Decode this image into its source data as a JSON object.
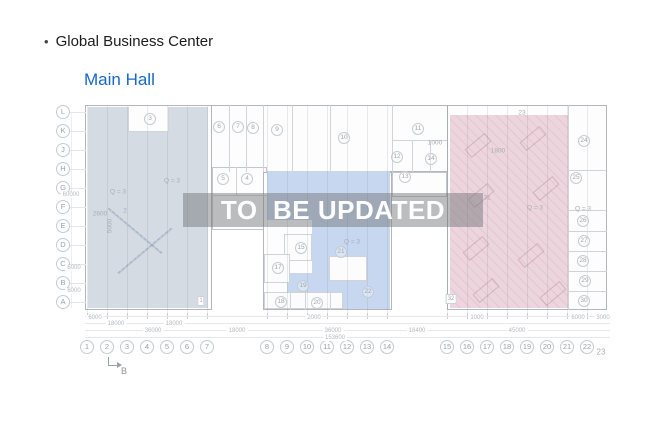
{
  "header": {
    "bullet": "•",
    "title": "Global Business Center",
    "subtitle": "Main Hall",
    "subtitle_color": "#1668c6"
  },
  "watermark": {
    "text": "TO  BE UPDATED"
  },
  "plan": {
    "colors": {
      "left_region": "#d4dbe3",
      "middle_region": "#c7d7f0",
      "right_region": "#edd5dd",
      "outer_wall": "#b3b7bc",
      "inner_wall": "#d0d4d9",
      "label_gray": "#a8adb4"
    },
    "row_labels": [
      "L",
      "K",
      "J",
      "H",
      "G",
      "F",
      "E",
      "D",
      "C",
      "B",
      "A"
    ],
    "col_labels": [
      {
        "label": "1",
        "x": 87
      },
      {
        "label": "2",
        "x": 107
      },
      {
        "label": "3",
        "x": 127
      },
      {
        "label": "4",
        "x": 147
      },
      {
        "label": "5",
        "x": 167
      },
      {
        "label": "6",
        "x": 187
      },
      {
        "label": "7",
        "x": 207
      },
      {
        "label": "8",
        "x": 267
      },
      {
        "label": "9",
        "x": 287
      },
      {
        "label": "10",
        "x": 307
      },
      {
        "label": "11",
        "x": 327
      },
      {
        "label": "12",
        "x": 347
      },
      {
        "label": "13",
        "x": 367
      },
      {
        "label": "14",
        "x": 387
      },
      {
        "label": "15",
        "x": 447
      },
      {
        "label": "16",
        "x": 467
      },
      {
        "label": "17",
        "x": 487
      },
      {
        "label": "18",
        "x": 507
      },
      {
        "label": "19",
        "x": 527
      },
      {
        "label": "20",
        "x": 547
      },
      {
        "label": "21",
        "x": 567
      },
      {
        "label": "22",
        "x": 587
      },
      {
        "label": "23",
        "x": 601,
        "y": 352,
        "plain": true
      }
    ],
    "rooms": [
      {
        "n": "3",
        "x": 150,
        "y": 119
      },
      {
        "n": "6",
        "x": 219,
        "y": 127
      },
      {
        "n": "7",
        "x": 238,
        "y": 127
      },
      {
        "n": "8",
        "x": 253,
        "y": 128
      },
      {
        "n": "9",
        "x": 277,
        "y": 130
      },
      {
        "n": "10",
        "x": 344,
        "y": 138
      },
      {
        "n": "11",
        "x": 418,
        "y": 129
      },
      {
        "n": "12",
        "x": 397,
        "y": 157
      },
      {
        "n": "13",
        "x": 405,
        "y": 177
      },
      {
        "n": "14",
        "x": 431,
        "y": 159
      },
      {
        "n": "5",
        "x": 223,
        "y": 179
      },
      {
        "n": "4",
        "x": 247,
        "y": 179
      },
      {
        "n": "15",
        "x": 301,
        "y": 248
      },
      {
        "n": "17",
        "x": 278,
        "y": 268
      },
      {
        "n": "19",
        "x": 303,
        "y": 286
      },
      {
        "n": "18",
        "x": 281,
        "y": 302
      },
      {
        "n": "20",
        "x": 317,
        "y": 303
      },
      {
        "n": "21",
        "x": 341,
        "y": 252
      },
      {
        "n": "22",
        "x": 368,
        "y": 292
      },
      {
        "n": "24",
        "x": 584,
        "y": 141
      },
      {
        "n": "25",
        "x": 576,
        "y": 178
      },
      {
        "n": "26",
        "x": 583,
        "y": 221
      },
      {
        "n": "27",
        "x": 584,
        "y": 241
      },
      {
        "n": "28",
        "x": 583,
        "y": 261
      },
      {
        "n": "29",
        "x": 585,
        "y": 281
      },
      {
        "n": "30",
        "x": 584,
        "y": 301
      }
    ],
    "texts": [
      {
        "t": "Q = 3",
        "x": 172,
        "y": 181
      },
      {
        "t": "Q = 3",
        "x": 118,
        "y": 192
      },
      {
        "t": "2600",
        "x": 100,
        "y": 214
      },
      {
        "t": "2",
        "x": 125,
        "y": 211
      },
      {
        "t": "5000",
        "x": 110,
        "y": 226,
        "rot": true
      },
      {
        "t": "Q = 3",
        "x": 352,
        "y": 242
      },
      {
        "t": "1000",
        "x": 435,
        "y": 143
      },
      {
        "t": "1800",
        "x": 498,
        "y": 151
      },
      {
        "t": "Q = 3",
        "x": 535,
        "y": 208
      },
      {
        "t": "Q = 3",
        "x": 583,
        "y": 209
      },
      {
        "t": "31",
        "x": 487,
        "y": 198
      },
      {
        "t": "23",
        "x": 522,
        "y": 113
      },
      {
        "t": "1",
        "x": 201,
        "y": 301,
        "box": true
      },
      {
        "t": "32",
        "x": 451,
        "y": 299,
        "box": true
      }
    ],
    "dims_bottom": [
      {
        "t": "6000",
        "x": 95,
        "y": 318
      },
      {
        "t": "2000",
        "x": 314,
        "y": 318
      },
      {
        "t": "1000",
        "x": 477,
        "y": 318
      },
      {
        "t": "6000",
        "x": 578,
        "y": 318
      },
      {
        "t": "3000",
        "x": 603,
        "y": 318
      },
      {
        "t": "18000",
        "x": 116,
        "y": 324
      },
      {
        "t": "18000",
        "x": 174,
        "y": 324
      },
      {
        "t": "36000",
        "x": 153,
        "y": 331
      },
      {
        "t": "18000",
        "x": 237,
        "y": 331
      },
      {
        "t": "36000",
        "x": 333,
        "y": 331
      },
      {
        "t": "18400",
        "x": 417,
        "y": 331
      },
      {
        "t": "45000",
        "x": 517,
        "y": 331
      },
      {
        "t": "153600",
        "x": 335,
        "y": 338
      }
    ],
    "dims_left": [
      {
        "t": "60000",
        "x": 71,
        "y": 195
      },
      {
        "t": "6000",
        "x": 74,
        "y": 268
      },
      {
        "t": "6000",
        "x": 74,
        "y": 291
      }
    ],
    "section_marker": {
      "label": "B"
    }
  }
}
